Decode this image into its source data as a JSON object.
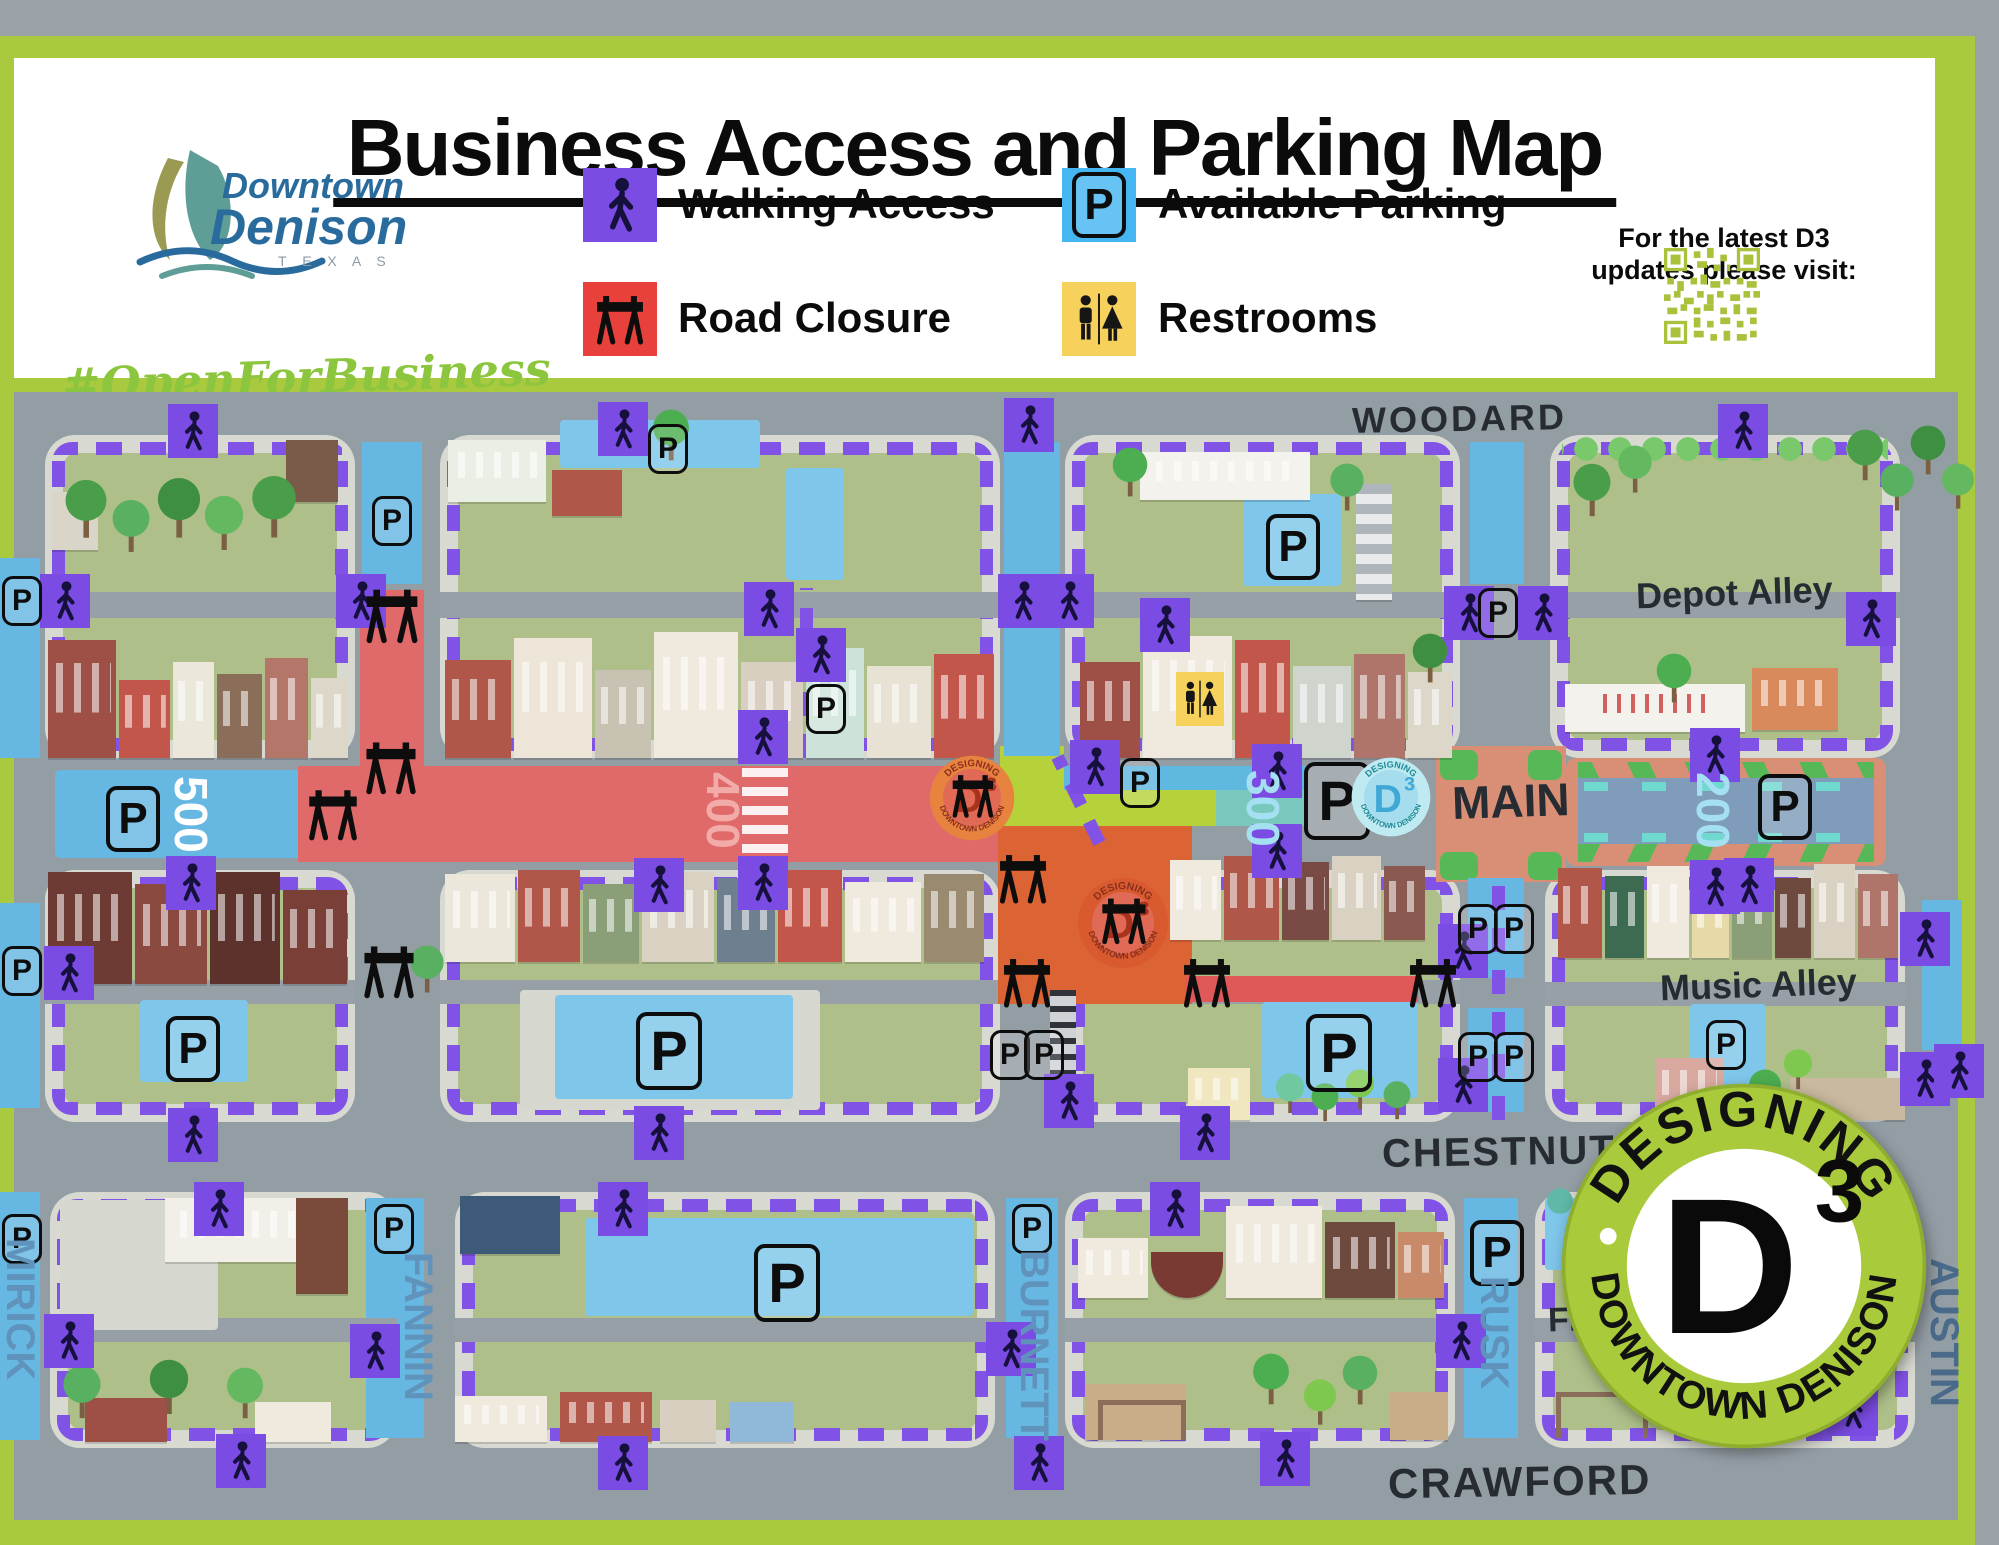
{
  "header": {
    "title": "Business Access and Parking Map",
    "brand": {
      "downtown": "Downtown",
      "denison": "Denison",
      "texas": "T E X A S",
      "hashtag": "#OpenForBusiness"
    },
    "legend": {
      "walking": "Walking Access",
      "parking": "Available Parking",
      "closure": "Road Closure",
      "restrooms": "Restrooms"
    },
    "qr": {
      "line1": "For the latest D3",
      "line2": "updates please visit:"
    }
  },
  "map": {
    "p": "P",
    "streets": {
      "woodard": "WOODARD",
      "main": "MAIN",
      "chestnut": "CHESTNUT",
      "crawford": "CRAWFORD",
      "mirick": "MIRICK",
      "fannin": "FANNIN",
      "burnett": "BURNETT",
      "rusk": "RUSK",
      "austin": "AUSTIN"
    },
    "alleys": {
      "depot": "Depot Alley",
      "music": "Music Alley",
      "firehouse": "Fireh"
    },
    "blocks": {
      "b500": "500",
      "b400": "400",
      "b300": "300",
      "b200": "200"
    },
    "d3": {
      "top": "DESIGNING",
      "bottom": "DOWNTOWN DENISON",
      "d": "D",
      "three": "3"
    },
    "colors": {
      "walking_purple": "#7b4ce3",
      "route_dash_purple": "#8152e6",
      "parking_blue": "#45b6f2",
      "pool_blue": "#7ec6ea",
      "closure_red": "#e8413c",
      "main_closure_red": "#e0696a",
      "orange_closure": "#dc6434",
      "restroom_yellow": "#f6d25c",
      "frame_green": "#a9c93e",
      "qr_green": "#a9c23c",
      "lawn_green": "#aebf8a",
      "street_gray": "#939da4"
    }
  }
}
